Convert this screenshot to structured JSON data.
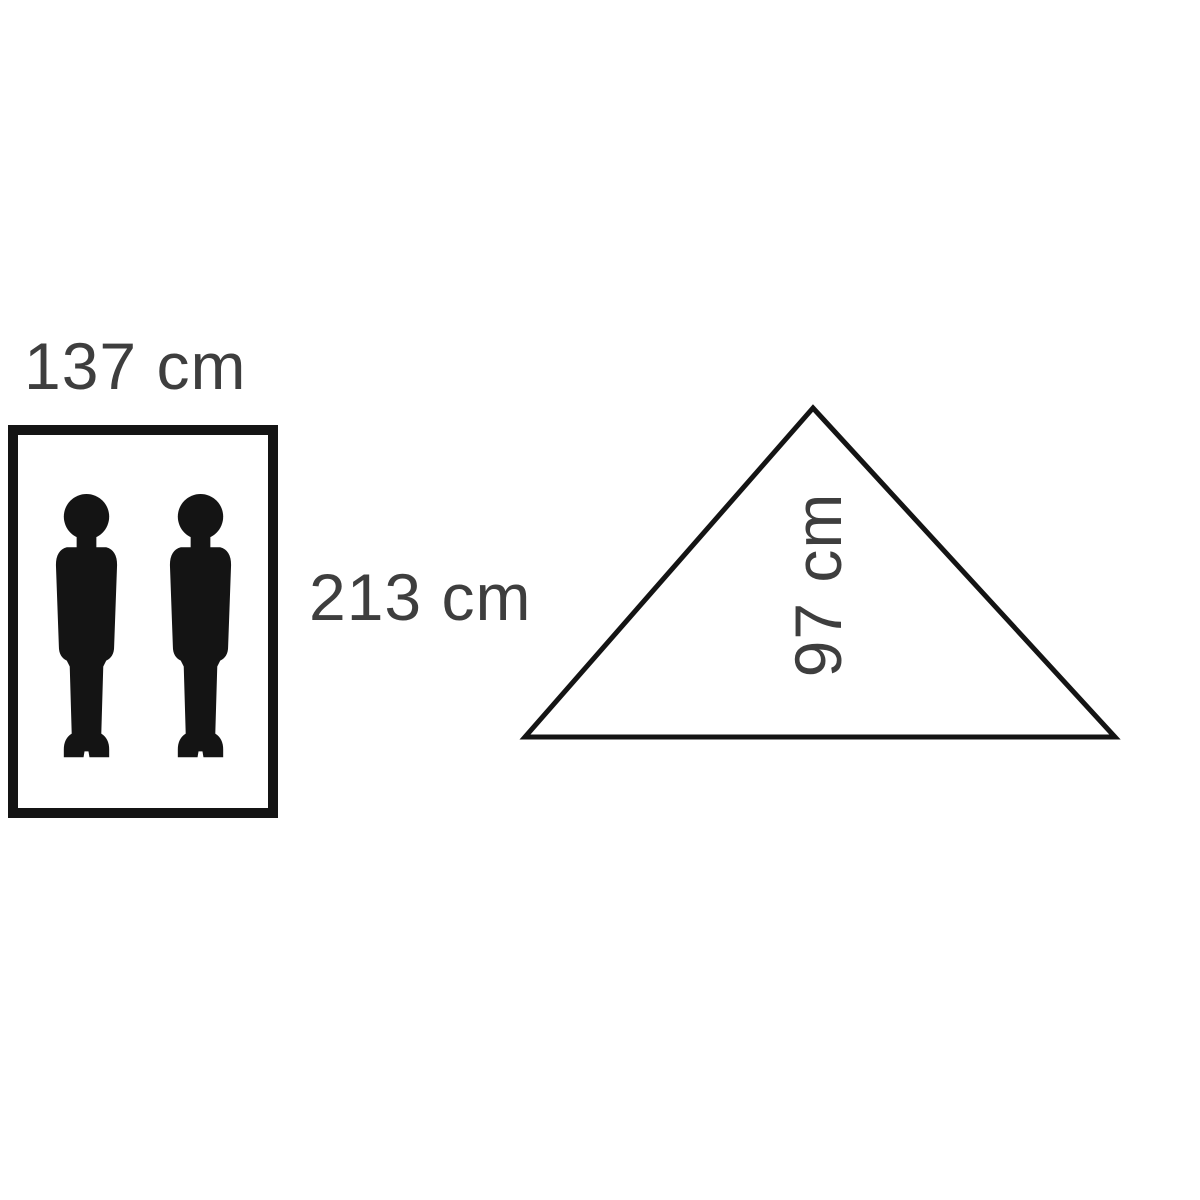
{
  "diagram": {
    "floor": {
      "width_label": "137 cm",
      "length_label": "213 cm",
      "person_count": 2
    },
    "cross_section": {
      "height_label": "97 cm"
    }
  },
  "icons": {
    "person": "standing-person-silhouette"
  },
  "colors": {
    "text": "#3e3e3e",
    "shape": "#141414",
    "background": "#ffffff"
  }
}
